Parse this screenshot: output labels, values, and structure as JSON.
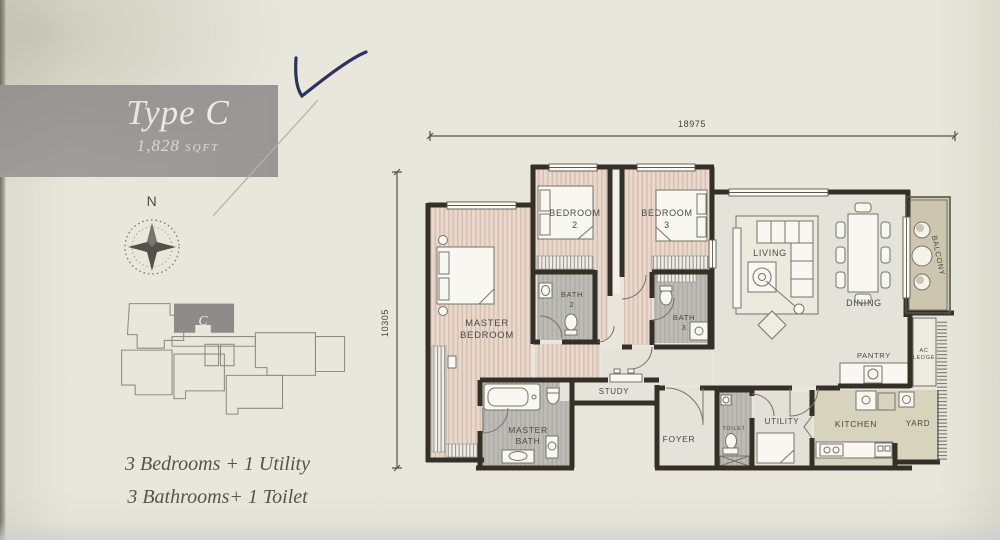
{
  "panel": {
    "title": "Type C",
    "area_value": "1,828",
    "area_unit": "SQFT",
    "compass_label": "N",
    "keyplan_unit": "C",
    "summary_line1": "3 Bedrooms + 1 Utility",
    "summary_line2": "3 Bathrooms+ 1 Toilet"
  },
  "plan": {
    "dim_top": "18975",
    "dim_left": "10305",
    "rooms": {
      "master_bedroom": [
        "MASTER",
        "BEDROOM"
      ],
      "bedroom2": [
        "BEDROOM",
        "2"
      ],
      "bedroom3": [
        "BEDROOM",
        "3"
      ],
      "bath2": [
        "BATH",
        "2"
      ],
      "bath3": [
        "BATH",
        "3"
      ],
      "master_bath": [
        "MASTER",
        "BATH"
      ],
      "living": "LIVING",
      "dining": "DINING",
      "balcony": "BALCONY",
      "pantry": "PANTRY",
      "ac_ledge": [
        "AC",
        "LEDGE"
      ],
      "study": "STUDY",
      "foyer": "FOYER",
      "toilet": "TOILET",
      "utility": "UTILITY",
      "kitchen": "KITCHEN",
      "yard": "YARD"
    }
  },
  "colors": {
    "paper": "#e9e6db",
    "banner_gray": "#9c9b99",
    "wall_dark": "#343028",
    "bedroom_floor": "#e9d8cc",
    "bedroom_stripe": "#d6bfb1",
    "bath_floor": "#bcbbb5",
    "living_floor": "#e4e3da",
    "kitchen_floor": "#d8d3bd",
    "balcony_floor": "#cdc6ae",
    "label_ink": "#4b4945",
    "pen_check_blue": "#2b3160"
  }
}
